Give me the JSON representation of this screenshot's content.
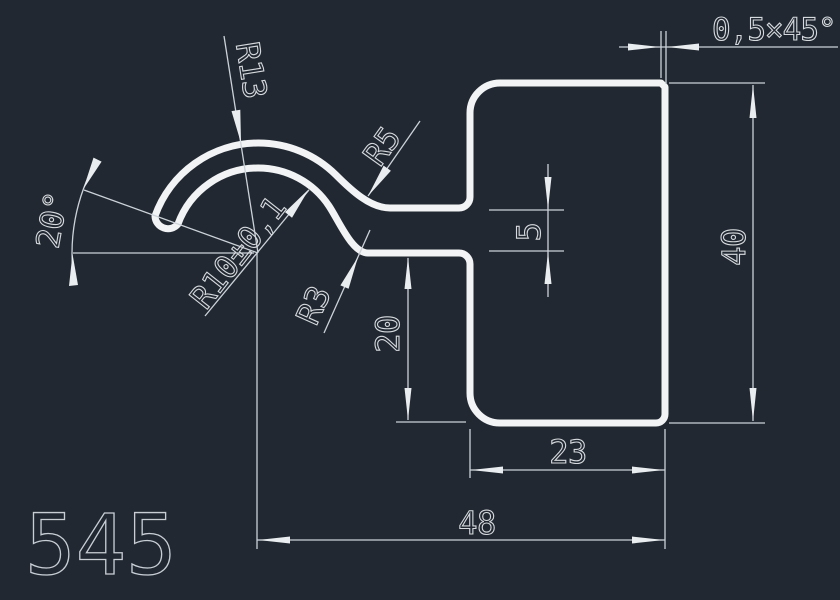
{
  "drawing": {
    "part_number": "545",
    "colors": {
      "background": "#212831",
      "profile_line": "#f1f3f5",
      "dimension_line": "#cdd2d9",
      "text": "#d6dade"
    },
    "labels": {
      "chamfer": "0,5×45°",
      "radius_13": "R13",
      "radius_10": "R10±0,1",
      "radius_5": "R5",
      "radius_3": "R3",
      "angle": "20°",
      "thickness_5": "5",
      "height_40": "40",
      "depth_20": "20",
      "width_23": "23",
      "width_48": "48"
    }
  }
}
